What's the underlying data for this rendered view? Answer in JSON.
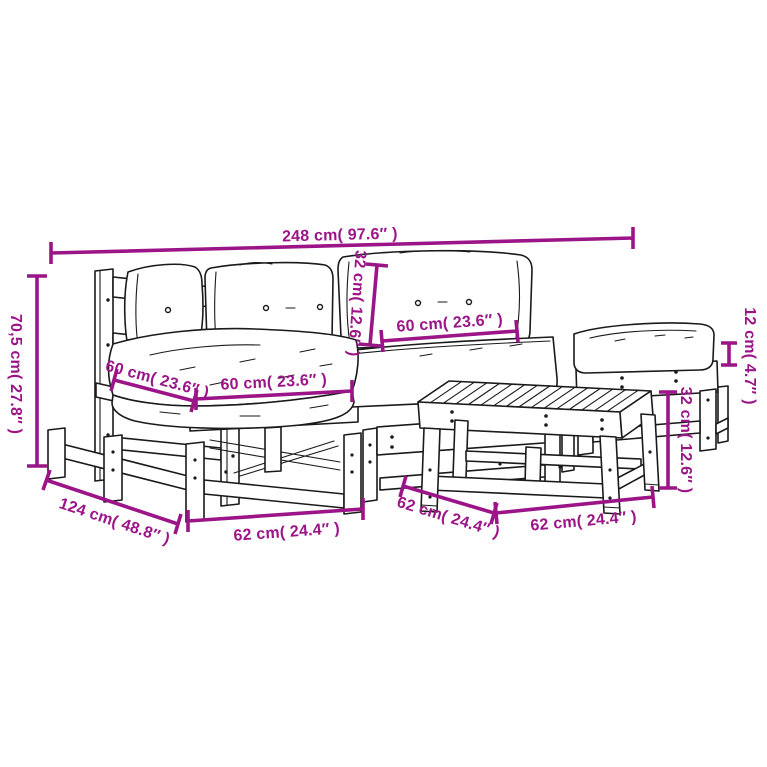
{
  "diagram": {
    "type": "product-dimension-diagram",
    "subject": "6-piece pallet garden lounge set with cushions (corner sofa, middle sofas, ottoman, footstool table)",
    "colors": {
      "dimension_accent": "#9C1588",
      "line_art": "#1a1a1a",
      "background": "#ffffff"
    },
    "dims": {
      "total_width": "248 cm( 97.6″ )",
      "total_height": "70,5 cm( 27.8″ )",
      "total_depth": "124 cm( 48.8″ )",
      "back_cushion_height": "32 cm( 12.6″ )",
      "back_cushion_width": "60 cm( 23.6″ )",
      "seat_cushion_depth": "60 cm( 23.6″ )",
      "seat_cushion_width": "60 cm( 23.6″ )",
      "ottoman_cushion_height": "12 cm( 4.7″ )",
      "module_width": "62 cm( 24.4″ )",
      "table_height": "32 cm( 12.6″ )",
      "table_depth": "62 cm( 24.4″ )",
      "table_width": "62 cm( 24.4″ )"
    }
  }
}
